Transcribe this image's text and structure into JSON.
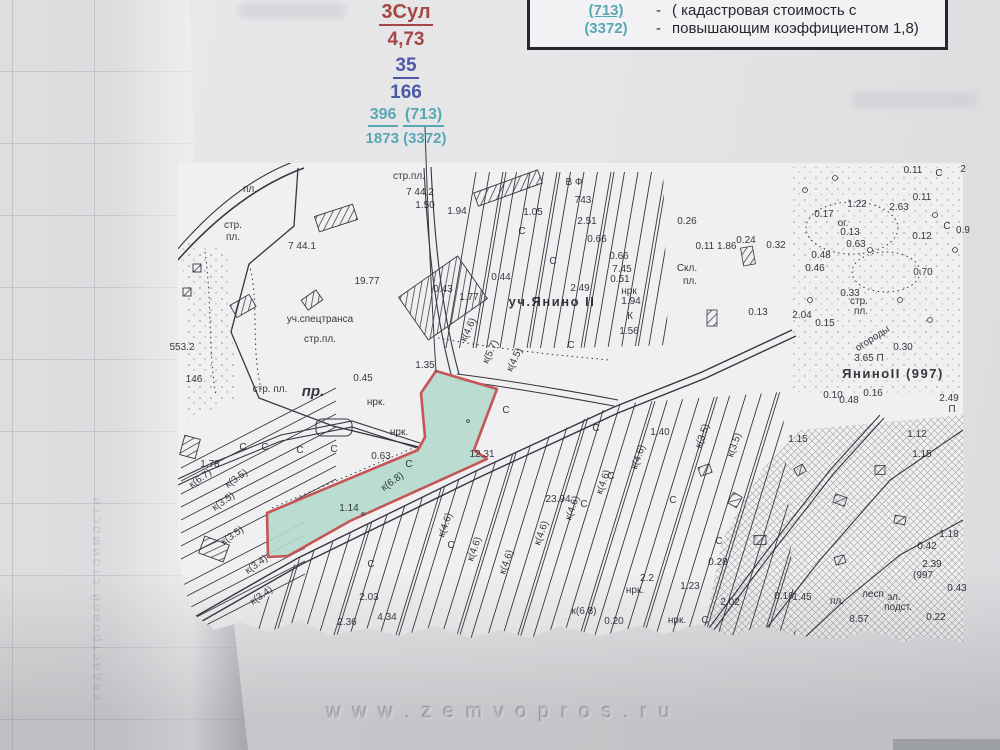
{
  "annotation": {
    "line1": "3Сул",
    "line2": "4,73",
    "line3": "35",
    "line4": "166",
    "line5a": "396",
    "line5b": "(713)",
    "line6": "1873 (3372)"
  },
  "legend": {
    "top_partial": "руб.",
    "rows": [
      {
        "value": "(713)",
        "dash": "-",
        "desc": "( кадастровая стоимость с"
      },
      {
        "value": "(3372)",
        "dash": "-",
        "desc": "повышающим коэффициентом 1,8)"
      }
    ]
  },
  "watermark": "w w w . z e m v o p r o s . r u",
  "underlay_text": "кадастровой стоимости",
  "colors": {
    "annotation_red": "#a64545",
    "annotation_blue": "#4a5aa8",
    "annotation_teal": "#58a8b4",
    "parcel_fill": "#aed7ca",
    "parcel_outline": "#c24848",
    "legend_border": "#26262e"
  },
  "map": {
    "labels": [
      {
        "t": "пл.",
        "x": 250,
        "y": 192,
        "s": 9
      },
      {
        "t": "стр.",
        "x": 233,
        "y": 228,
        "s": 10
      },
      {
        "t": "пл.",
        "x": 233,
        "y": 240,
        "s": 10
      },
      {
        "t": "стр.пл.",
        "x": 409,
        "y": 179,
        "s": 9
      },
      {
        "t": "7 44.2",
        "x": 420,
        "y": 195,
        "s": 10
      },
      {
        "t": "1.50",
        "x": 425,
        "y": 208,
        "s": 10
      },
      {
        "t": "7 44.1",
        "x": 302,
        "y": 249,
        "s": 11
      },
      {
        "t": "19.77",
        "x": 367,
        "y": 284,
        "s": 11
      },
      {
        "t": "553.2",
        "x": 182,
        "y": 350,
        "s": 10
      },
      {
        "t": "уч.спецтранса",
        "x": 320,
        "y": 322,
        "s": 11
      },
      {
        "t": "стр.пл.",
        "x": 320,
        "y": 342,
        "s": 11
      },
      {
        "t": "стр. пл.",
        "x": 270,
        "y": 392,
        "s": 10
      },
      {
        "t": "пр.",
        "x": 313,
        "y": 396,
        "c": "it"
      },
      {
        "t": "0.45",
        "x": 363,
        "y": 381,
        "s": 11
      },
      {
        "t": "1.35",
        "x": 425,
        "y": 368,
        "s": 10
      },
      {
        "t": "146",
        "x": 194,
        "y": 382,
        "s": 9
      },
      {
        "t": "1.94",
        "x": 457,
        "y": 214,
        "s": 10
      },
      {
        "t": "1.05",
        "x": 533,
        "y": 215,
        "s": 10
      },
      {
        "t": "В Ф",
        "x": 574,
        "y": 185,
        "s": 10
      },
      {
        "t": "743",
        "x": 583,
        "y": 203,
        "s": 10
      },
      {
        "t": "2.51",
        "x": 587,
        "y": 224,
        "s": 10
      },
      {
        "t": "0.66",
        "x": 597,
        "y": 242,
        "s": 10
      },
      {
        "t": "0.66",
        "x": 619,
        "y": 259,
        "s": 10
      },
      {
        "t": "7.45",
        "x": 622,
        "y": 272,
        "s": 10
      },
      {
        "t": "0.51",
        "x": 620,
        "y": 282,
        "s": 10
      },
      {
        "t": "нрк",
        "x": 629,
        "y": 294,
        "s": 9
      },
      {
        "t": "1.94",
        "x": 631,
        "y": 304,
        "s": 10
      },
      {
        "t": "К",
        "x": 630,
        "y": 319,
        "s": 11
      },
      {
        "t": "1.56",
        "x": 629,
        "y": 334,
        "s": 10
      },
      {
        "t": "0.44",
        "x": 501,
        "y": 280,
        "s": 10
      },
      {
        "t": "2.49",
        "x": 580,
        "y": 291,
        "s": 10
      },
      {
        "t": "уч.Янино II",
        "x": 552,
        "y": 306,
        "c": "big"
      },
      {
        "t": "0.43",
        "x": 443,
        "y": 292,
        "s": 9
      },
      {
        "t": "1.77",
        "x": 469,
        "y": 300,
        "s": 9
      },
      {
        "t": "к(5.7)",
        "x": 493,
        "y": 353,
        "s": 8,
        "r": -65
      },
      {
        "t": "к(4.5)",
        "x": 517,
        "y": 361,
        "s": 8,
        "r": -65
      },
      {
        "t": "к(4.6)",
        "x": 471,
        "y": 331,
        "s": 8,
        "r": -65
      },
      {
        "t": "С",
        "x": 522,
        "y": 234,
        "s": 11
      },
      {
        "t": "С",
        "x": 553,
        "y": 264,
        "s": 11
      },
      {
        "t": "С",
        "x": 571,
        "y": 348,
        "s": 11
      },
      {
        "t": "1.78",
        "x": 210,
        "y": 467,
        "s": 10
      },
      {
        "t": "к(6.7)",
        "x": 202,
        "y": 481,
        "s": 8,
        "r": -35
      },
      {
        "t": "к(3.5)",
        "x": 238,
        "y": 481,
        "s": 8,
        "r": -35
      },
      {
        "t": "к(3.5)",
        "x": 225,
        "y": 504,
        "s": 8,
        "r": -35
      },
      {
        "t": "к(3.5)",
        "x": 234,
        "y": 538,
        "s": 8,
        "r": -35
      },
      {
        "t": "к(3.4)",
        "x": 258,
        "y": 567,
        "s": 8,
        "r": -35
      },
      {
        "t": "к(3.4)",
        "x": 263,
        "y": 598,
        "s": 8,
        "r": -35
      },
      {
        "t": "С",
        "x": 243,
        "y": 450,
        "s": 11
      },
      {
        "t": "С",
        "x": 265,
        "y": 450,
        "s": 11
      },
      {
        "t": "С",
        "x": 300,
        "y": 453,
        "s": 11
      },
      {
        "t": "С",
        "x": 334,
        "y": 452,
        "s": 11
      },
      {
        "t": "12.31",
        "x": 482,
        "y": 457,
        "s": 11
      },
      {
        "t": "0.63",
        "x": 381,
        "y": 459,
        "s": 9
      },
      {
        "t": "1.14",
        "x": 349,
        "y": 511,
        "s": 10
      },
      {
        "t": "к(6.8)",
        "x": 394,
        "y": 484,
        "s": 8,
        "r": -35
      },
      {
        "t": "нрк.",
        "x": 376,
        "y": 405,
        "s": 9
      },
      {
        "t": "нрк.",
        "x": 399,
        "y": 435,
        "s": 9
      },
      {
        "t": "С",
        "x": 409,
        "y": 467,
        "s": 11
      },
      {
        "t": "С",
        "x": 506,
        "y": 413,
        "s": 11
      },
      {
        "t": "23.94",
        "x": 558,
        "y": 502,
        "s": 11
      },
      {
        "t": "2.03",
        "x": 369,
        "y": 600,
        "s": 10
      },
      {
        "t": "2.36",
        "x": 347,
        "y": 625,
        "s": 10
      },
      {
        "t": "4.34",
        "x": 387,
        "y": 620,
        "s": 11
      },
      {
        "t": "к(6.8)",
        "x": 584,
        "y": 614,
        "s": 10
      },
      {
        "t": "0.20",
        "x": 614,
        "y": 624,
        "s": 10
      },
      {
        "t": "2.2",
        "x": 647,
        "y": 581,
        "s": 10
      },
      {
        "t": "нрк.",
        "x": 635,
        "y": 593,
        "s": 9
      },
      {
        "t": "нрк.",
        "x": 677,
        "y": 623,
        "s": 9
      },
      {
        "t": "1.23",
        "x": 690,
        "y": 589,
        "s": 10
      },
      {
        "t": "2.02",
        "x": 730,
        "y": 605,
        "s": 10
      },
      {
        "t": "0.28",
        "x": 718,
        "y": 565,
        "s": 10
      },
      {
        "t": "С",
        "x": 705,
        "y": 623,
        "s": 11
      },
      {
        "t": "к(4.6)",
        "x": 448,
        "y": 526,
        "s": 8,
        "r": -70
      },
      {
        "t": "к(4.6)",
        "x": 477,
        "y": 550,
        "s": 8,
        "r": -70
      },
      {
        "t": "к(4.6)",
        "x": 509,
        "y": 563,
        "s": 8,
        "r": -70
      },
      {
        "t": "к(4.6)",
        "x": 544,
        "y": 534,
        "s": 8,
        "r": -70
      },
      {
        "t": "к(4.6)",
        "x": 575,
        "y": 509,
        "s": 8,
        "r": -70
      },
      {
        "t": "к(4.6)",
        "x": 606,
        "y": 483,
        "s": 8,
        "r": -70
      },
      {
        "t": "к(4.6)",
        "x": 641,
        "y": 458,
        "s": 8,
        "r": -70
      },
      {
        "t": "к(3.5)",
        "x": 705,
        "y": 437,
        "s": 8,
        "r": -70
      },
      {
        "t": "к(3.5)",
        "x": 737,
        "y": 446,
        "s": 8,
        "r": -70
      },
      {
        "t": "С",
        "x": 371,
        "y": 567,
        "s": 11
      },
      {
        "t": "С",
        "x": 451,
        "y": 548,
        "s": 11
      },
      {
        "t": "С",
        "x": 584,
        "y": 507,
        "s": 11
      },
      {
        "t": "С",
        "x": 611,
        "y": 479,
        "s": 11
      },
      {
        "t": "С",
        "x": 673,
        "y": 503,
        "s": 11
      },
      {
        "t": "С",
        "x": 719,
        "y": 544,
        "s": 11
      },
      {
        "t": "С",
        "x": 596,
        "y": 431,
        "s": 11
      },
      {
        "t": "1.40",
        "x": 660,
        "y": 435,
        "s": 8
      },
      {
        "t": "1.22",
        "x": 857,
        "y": 207,
        "s": 10
      },
      {
        "t": "2.63",
        "x": 899,
        "y": 210,
        "s": 10
      },
      {
        "t": "0.11",
        "x": 922,
        "y": 200,
        "s": 9
      },
      {
        "t": "0.17",
        "x": 824,
        "y": 217,
        "s": 10
      },
      {
        "t": "ог.",
        "x": 843,
        "y": 226,
        "s": 8
      },
      {
        "t": "0.13",
        "x": 850,
        "y": 235,
        "s": 9
      },
      {
        "t": "0.63",
        "x": 856,
        "y": 247,
        "s": 9
      },
      {
        "t": "0.12",
        "x": 922,
        "y": 239,
        "s": 9
      },
      {
        "t": "0.9",
        "x": 963,
        "y": 233,
        "s": 9
      },
      {
        "t": "С",
        "x": 947,
        "y": 229,
        "s": 11
      },
      {
        "t": "0.48",
        "x": 821,
        "y": 258,
        "s": 9
      },
      {
        "t": "0.46",
        "x": 815,
        "y": 271,
        "s": 9
      },
      {
        "t": "0.70",
        "x": 923,
        "y": 275,
        "s": 9
      },
      {
        "t": "0.33",
        "x": 850,
        "y": 296,
        "s": 9
      },
      {
        "t": "2.04",
        "x": 802,
        "y": 318,
        "s": 9
      },
      {
        "t": "0.15",
        "x": 825,
        "y": 326,
        "s": 9
      },
      {
        "t": "стр.",
        "x": 859,
        "y": 304,
        "s": 8
      },
      {
        "t": "пл.",
        "x": 861,
        "y": 314,
        "s": 8
      },
      {
        "t": "3.65 П",
        "x": 869,
        "y": 361,
        "s": 10
      },
      {
        "t": "ЯниноII (997)",
        "x": 893,
        "y": 378,
        "c": "big"
      },
      {
        "t": "0.30",
        "x": 903,
        "y": 350,
        "s": 9
      },
      {
        "t": "2.49",
        "x": 949,
        "y": 401,
        "s": 9
      },
      {
        "t": "П",
        "x": 952,
        "y": 412,
        "s": 9
      },
      {
        "t": "0.10",
        "x": 833,
        "y": 398,
        "s": 8
      },
      {
        "t": "0.48",
        "x": 849,
        "y": 403,
        "s": 8
      },
      {
        "t": "0.16",
        "x": 873,
        "y": 396,
        "s": 8
      },
      {
        "t": "Скл.",
        "x": 687,
        "y": 271,
        "s": 9
      },
      {
        "t": "пл.",
        "x": 690,
        "y": 284,
        "s": 8
      },
      {
        "t": "0.26",
        "x": 687,
        "y": 224,
        "s": 9
      },
      {
        "t": "0.24",
        "x": 746,
        "y": 243,
        "s": 9
      },
      {
        "t": "0.32",
        "x": 776,
        "y": 248,
        "s": 9
      },
      {
        "t": "0.11 1.86",
        "x": 716,
        "y": 249,
        "s": 8
      },
      {
        "t": "огороды",
        "x": 874,
        "y": 341,
        "s": 9,
        "r": -33
      },
      {
        "t": "0.11",
        "x": 913,
        "y": 173,
        "s": 8
      },
      {
        "t": "С",
        "x": 939,
        "y": 176,
        "s": 10
      },
      {
        "t": "2",
        "x": 963,
        "y": 172,
        "s": 9
      },
      {
        "t": "0.13",
        "x": 758,
        "y": 315,
        "s": 8
      },
      {
        "t": "1.12",
        "x": 917,
        "y": 437,
        "s": 9
      },
      {
        "t": "1.15",
        "x": 798,
        "y": 442,
        "s": 9
      },
      {
        "t": "1.15",
        "x": 922,
        "y": 457,
        "s": 9
      },
      {
        "t": "1.18",
        "x": 949,
        "y": 537,
        "s": 9
      },
      {
        "t": "0.42",
        "x": 927,
        "y": 549,
        "s": 9
      },
      {
        "t": "2.39",
        "x": 932,
        "y": 567,
        "s": 8
      },
      {
        "t": "(997",
        "x": 923,
        "y": 578,
        "s": 9
      },
      {
        "t": "0.43",
        "x": 957,
        "y": 591,
        "s": 9
      },
      {
        "t": "0.22",
        "x": 936,
        "y": 620,
        "s": 9
      },
      {
        "t": "8.57",
        "x": 859,
        "y": 622,
        "s": 9
      },
      {
        "t": "лесп",
        "x": 873,
        "y": 597,
        "s": 8
      },
      {
        "t": "эл.",
        "x": 894,
        "y": 600,
        "s": 8
      },
      {
        "t": "подст.",
        "x": 898,
        "y": 610,
        "s": 8
      },
      {
        "t": "пл.",
        "x": 837,
        "y": 604,
        "s": 8
      },
      {
        "t": "0.16",
        "x": 784,
        "y": 599,
        "s": 8
      },
      {
        "t": "1.45",
        "x": 802,
        "y": 600,
        "s": 8
      }
    ]
  }
}
